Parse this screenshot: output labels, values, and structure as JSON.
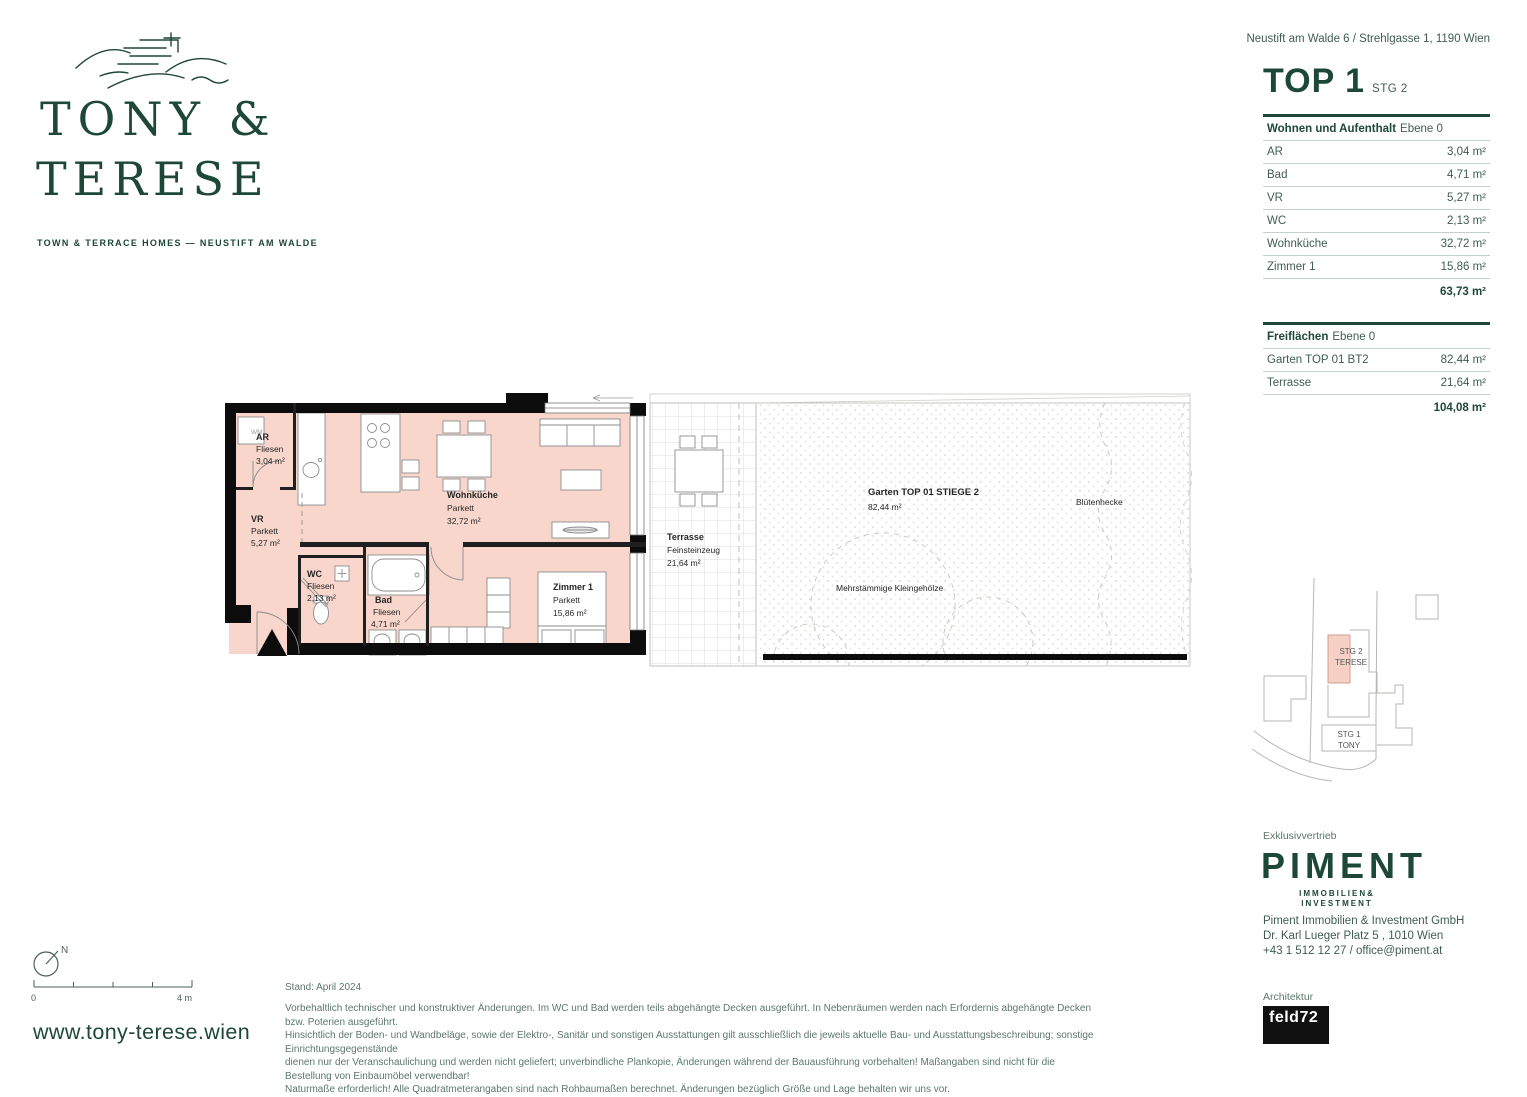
{
  "header": {
    "address": "Neustift am Walde 6 / Strehlgasse 1, 1190 Wien",
    "title": "TOP 1",
    "subtitle": "STG 2"
  },
  "brand": {
    "line1": "TONY &",
    "line2": "TERESE",
    "tagline": "TOWN & TERRACE HOMES — NEUSTIFT AM WALDE",
    "website": "www.tony-terese.wien"
  },
  "tables": {
    "living": {
      "title": "Wohnen und Aufenthalt",
      "level": "Ebene 0",
      "rows": [
        {
          "label": "AR",
          "value": "3,04 m²"
        },
        {
          "label": "Bad",
          "value": "4,71 m²"
        },
        {
          "label": "VR",
          "value": "5,27 m²"
        },
        {
          "label": "WC",
          "value": "2,13 m²"
        },
        {
          "label": "Wohnküche",
          "value": "32,72 m²"
        },
        {
          "label": "Zimmer 1",
          "value": "15,86 m²"
        }
      ],
      "total": "63,73 m²"
    },
    "open": {
      "title": "Freiflächen",
      "level": "Ebene 0",
      "rows": [
        {
          "label": "Garten TOP 01 BT2",
          "value": "82,44 m²"
        },
        {
          "label": "Terrasse",
          "value": "21,64 m²"
        }
      ],
      "total": "104,08 m²"
    }
  },
  "plan": {
    "rooms": [
      {
        "name": "AR",
        "floor": "Fliesen",
        "area": "3,04 m²"
      },
      {
        "name": "VR",
        "floor": "Parkett",
        "area": "5,27 m²"
      },
      {
        "name": "WC",
        "floor": "Fliesen",
        "area": "2,13 m²"
      },
      {
        "name": "Bad",
        "floor": "Fliesen",
        "area": "4,71 m²"
      },
      {
        "name": "Wohnküche",
        "floor": "Parkett",
        "area": "32,72 m²"
      },
      {
        "name": "Zimmer 1",
        "floor": "Parkett",
        "area": "15,86 m²"
      }
    ],
    "terrace": {
      "name": "Terrasse",
      "floor": "Feinsteinzeug",
      "area": "21,64 m²"
    },
    "garden": {
      "name": "Garten TOP 01 STIEGE 2",
      "area": "82,44 m²"
    },
    "shrub_label": "Mehrstämmige Kleingehölze",
    "hedge_label": "Blütenhecke",
    "wm_label": "WM"
  },
  "siteplan": {
    "stg2_line1": "STG 2",
    "stg2_line2": "TERESE",
    "stg1_line1": "STG 1",
    "stg1_line2": "TONY"
  },
  "compass": {
    "north": "N",
    "scale_start": "0",
    "scale_end": "4 m"
  },
  "footer": {
    "stand": "Stand: April 2024",
    "disclaimer": [
      "Vorbehaltlich technischer und konstruktiver Änderungen. Im WC und Bad werden teils abgehängte Decken ausgeführt. In Nebenräumen werden nach Erfordernis abgehängte Decken bzw. Poterien ausgeführt.",
      "Hinsichtlich der Boden- und Wandbeläge, sowie der Elektro-, Sanitär und sonstigen Ausstattungen gilt ausschließlich die jeweils aktuelle Bau- und Ausstattungsbeschreibung; sonstige Einrichtungsgegenstände",
      "dienen nur der Veranschaulichung und werden nicht geliefert; unverbindliche Plankopie, Änderungen während der Bauausführung vorbehalten! Maßangaben sind nicht für die Bestellung von Einbaumöbel verwendbar!",
      "Naturmaße erforderlich! Alle Quadratmeterangaben sind nach Rohbaumaßen berechnet. Änderungen bezüglich Größe und Lage behalten wir uns vor."
    ]
  },
  "vendor": {
    "label": "Exklusivvertrieb",
    "logo": "PIMENT",
    "sub1": "IMMOBILIEN&",
    "sub2": "INVESTMENT",
    "line1": "Piment Immobilien & Investment GmbH",
    "line2": "Dr. Karl Lueger Platz 5 , 1010 Wien",
    "line3": "+43 1 512 12 27 / office@piment.at"
  },
  "architect": {
    "label": "Architektur",
    "logo": "feld72"
  }
}
